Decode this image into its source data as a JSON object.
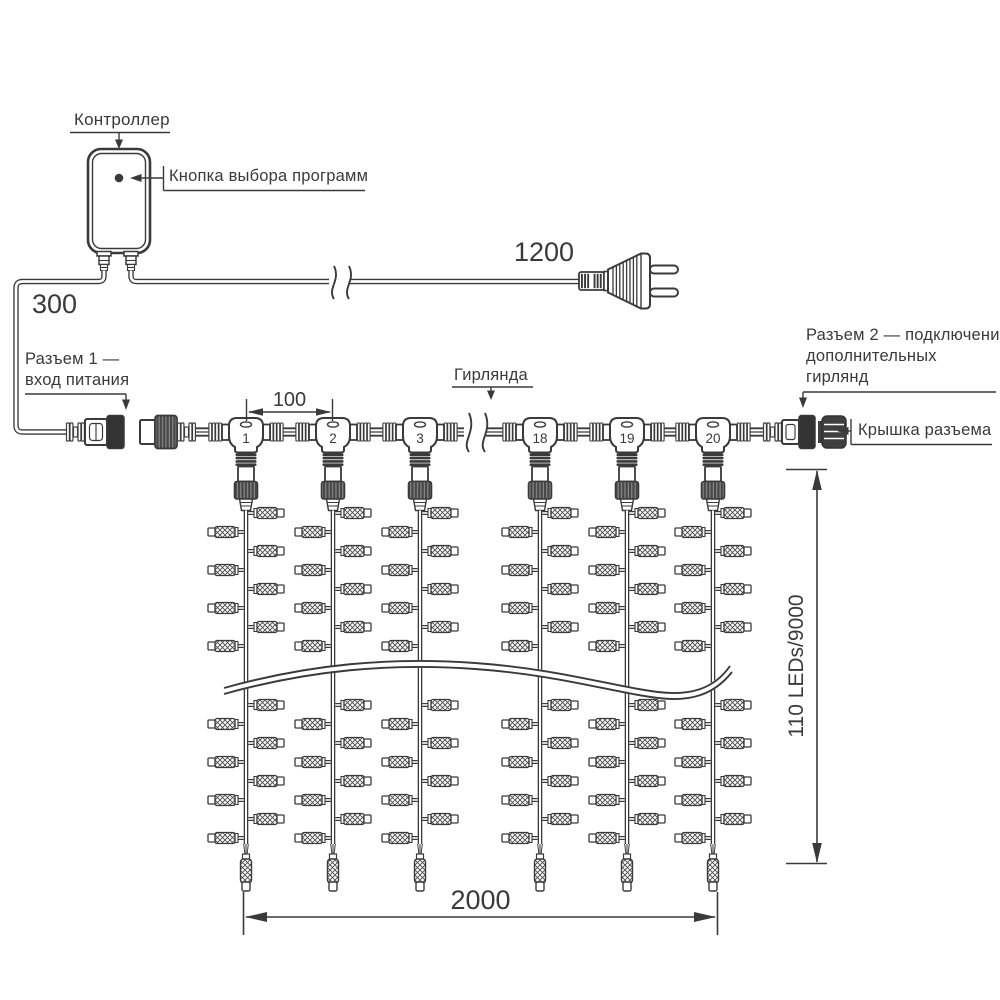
{
  "labels": {
    "controller": "Контроллер",
    "program_button": "Кнопка выбора программ",
    "connector1_line1": "Разъем 1 —",
    "connector1_line2": "вход питания",
    "garland": "Гирлянда",
    "connector2_line1": "Разъем 2 — подключение",
    "connector2_line2": "дополнительных",
    "connector2_line3": "гирлянд",
    "connector_cap": "Крышка разъема"
  },
  "dimensions": {
    "power_input_drop": "300",
    "cord_length": "1200",
    "drop_spacing": "100",
    "curtain_width": "2000",
    "curtain_height": "110 LEDs/9000"
  },
  "junctions": [
    "1",
    "2",
    "3",
    "18",
    "19",
    "20"
  ],
  "colors": {
    "line": "#3a3a3a",
    "dark_fill": "#333333",
    "background": "#ffffff"
  }
}
